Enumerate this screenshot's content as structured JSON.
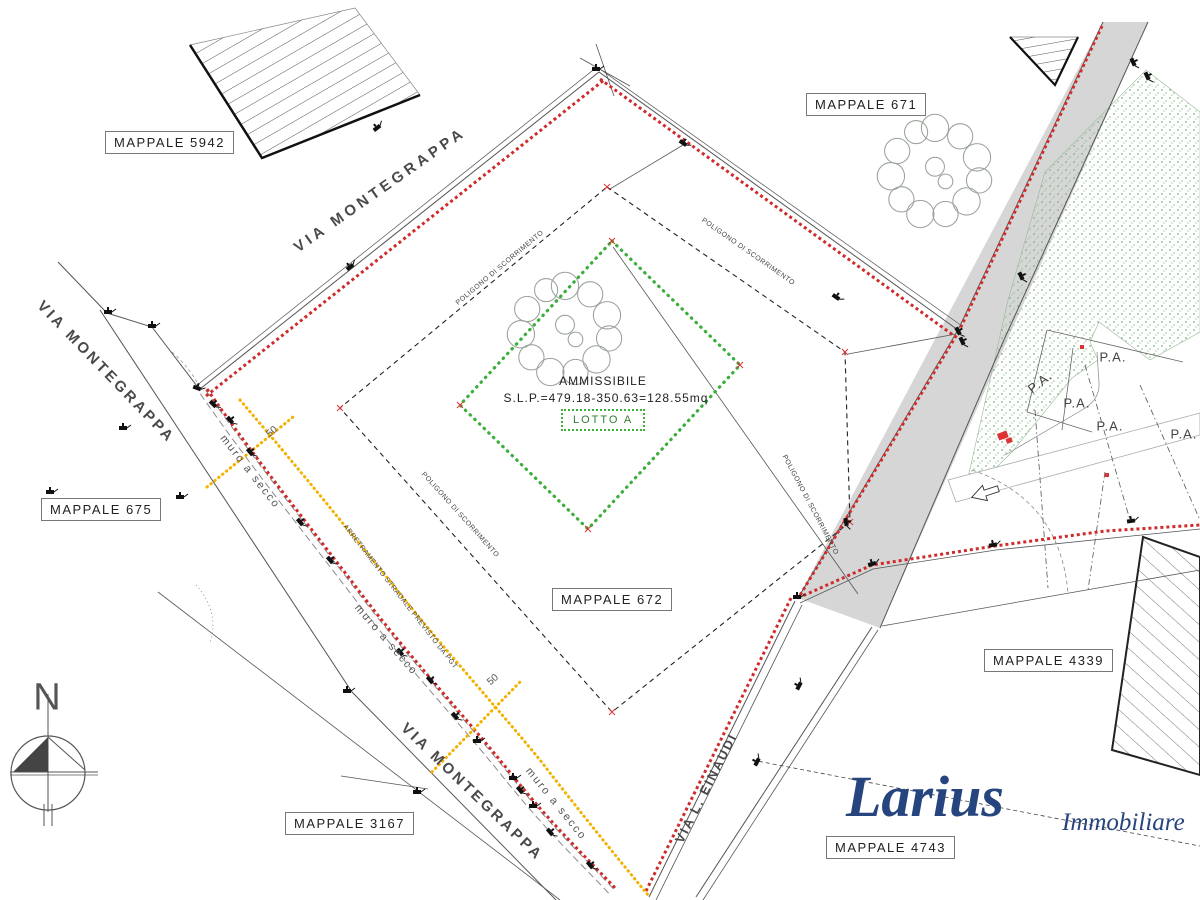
{
  "map": {
    "parcels": {
      "p5942": "MAPPALE 5942",
      "p671": "MAPPALE 671",
      "p675": "MAPPALE 675",
      "p672": "MAPPALE 672",
      "p3167": "MAPPALE 3167",
      "p4339": "MAPPALE 4339",
      "p4743": "MAPPALE 4743"
    },
    "streets": {
      "montegrappa": "VIA MONTEGRAPPA",
      "einaudi": "VIA L. EINAUDI"
    },
    "lot": {
      "status": "AMMISSIBILE",
      "slp": "S.L.P.=479.18-350.63=128.55mq",
      "name": "LOTTO A"
    },
    "notes": {
      "wall": "muro a secco",
      "setback": "ARRETRAMENTO STRADALE PREVISTO DA PGT",
      "polygon": "POLIGONO DI SCORRIMENTO",
      "pa": "P.A.",
      "fifty": "50"
    },
    "compass": {
      "north": "N"
    },
    "logo": {
      "brand": "Larius",
      "suffix": "Immobiliare"
    },
    "colors": {
      "boundary_red": "#cf2b2b",
      "lot_green": "#3cae3c",
      "setback_yellow": "#f2b200",
      "road_gray": "#d6d6d6",
      "logo_blue": "#26447e"
    }
  }
}
